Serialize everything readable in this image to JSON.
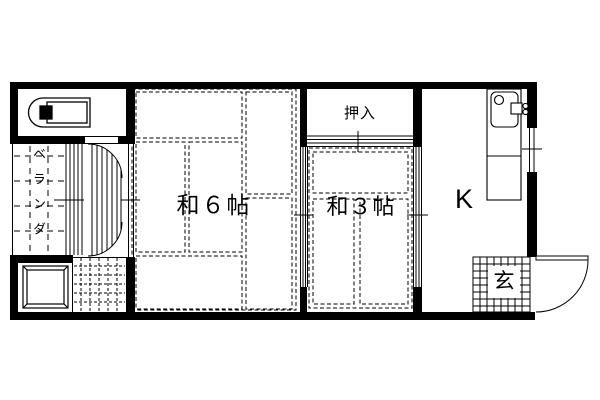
{
  "page": {
    "type": "floor-plan",
    "background": "#ffffff",
    "line_color": "#000000"
  },
  "rooms": {
    "japanese_room_6": {
      "label": "和６帖"
    },
    "japanese_room_3": {
      "label": "和３帖"
    },
    "kitchen": {
      "label": "K"
    },
    "closet": {
      "label": "押入"
    },
    "entrance": {
      "label": "玄"
    },
    "veranda": {
      "label": "ベランダ"
    }
  },
  "fixtures": {
    "bathtub": "bathtub-icon",
    "kitchen_sink": "kitchen-sink-icon",
    "washer_pan": "washer-pan-icon",
    "entrance_door": "door-swing-icon",
    "hall_doors": "double-door-swing-icon",
    "veranda_window": "sliding-window-icon",
    "kitchen_window": "sliding-window-icon",
    "closet_doors": "fusuma-sliding-door-icon",
    "room_partitions": "sliding-partition-icon",
    "tatami": "tatami-mat-pattern",
    "entrance_floor": "tile-grid-pattern",
    "utility_floor": "tile-grid-pattern"
  }
}
